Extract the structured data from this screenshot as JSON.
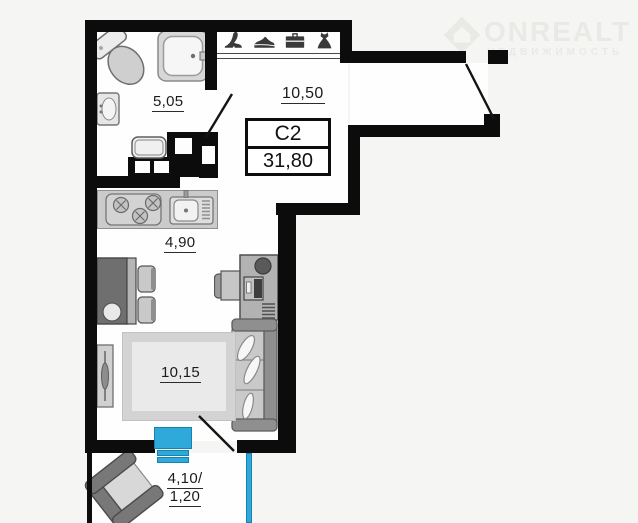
{
  "unit_card": {
    "type_label": "C2",
    "total_area": "31,80"
  },
  "watermark": {
    "brand": "ONREALT",
    "subtitle": "НЕДВИЖИМОСТЬ"
  },
  "rooms": {
    "bathroom": {
      "area": "5,05"
    },
    "hallway": {
      "area": "10,50"
    },
    "kitchen": {
      "area": "4,90"
    },
    "living_room": {
      "area": "10,15"
    },
    "balcony": {
      "area_full": "4,10/",
      "area_reduced": "1,20"
    }
  },
  "closet_icons": [
    "heel-shoe-icon",
    "sneaker-icon",
    "briefcase-icon",
    "dress-icon"
  ],
  "furniture_symbols": [
    "toilet",
    "shower-cabin",
    "washbasin",
    "washing-machine",
    "stove",
    "kitchen-sink",
    "dining-table",
    "dining-chairs",
    "desk",
    "desk-chair",
    "monitor",
    "sofa",
    "pillows",
    "rug",
    "radiator",
    "balcony-armchair"
  ],
  "colors": {
    "walls": "#0c0c0c",
    "window_blue": "#2fa9da",
    "balcony_glazing_blue": "#2fa9da",
    "furniture_gray": "#c9c9c9",
    "watermark_gray": "#e9e9e6",
    "background": "#f5f5f3",
    "floor": "#fefefe"
  }
}
